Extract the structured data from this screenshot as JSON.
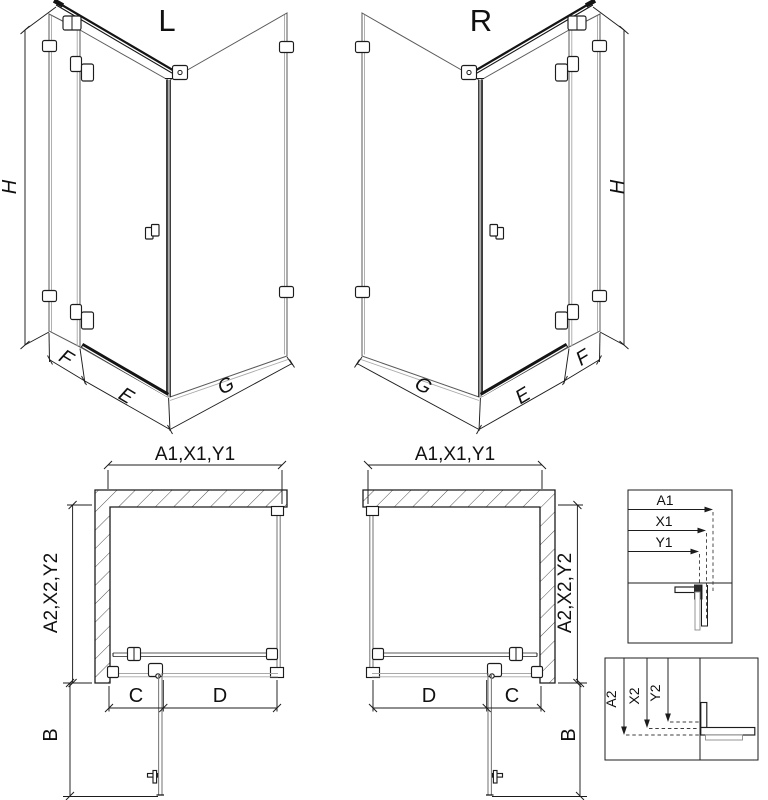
{
  "iso_views": {
    "left": {
      "label": "L"
    },
    "right": {
      "label": "R"
    },
    "dims": {
      "height": "H",
      "wall_depth": "F",
      "door_width": "E",
      "side_width": "G"
    }
  },
  "plan_views": {
    "width_label": "A1,X1,Y1",
    "depth_label": "A2,X2,Y2",
    "dims": {
      "fixed_segment": "C",
      "door_segment": "D",
      "door_open_depth": "B"
    }
  },
  "detail_boxes": {
    "widths": {
      "labels": [
        "A1",
        "X1",
        "Y1"
      ]
    },
    "depths": {
      "labels": [
        "A2",
        "X2",
        "Y2"
      ]
    }
  },
  "colors": {
    "line": "#1c1c1c",
    "glass": "#7d7d7d",
    "dark_bar": "#141414",
    "background": "#ffffff"
  }
}
